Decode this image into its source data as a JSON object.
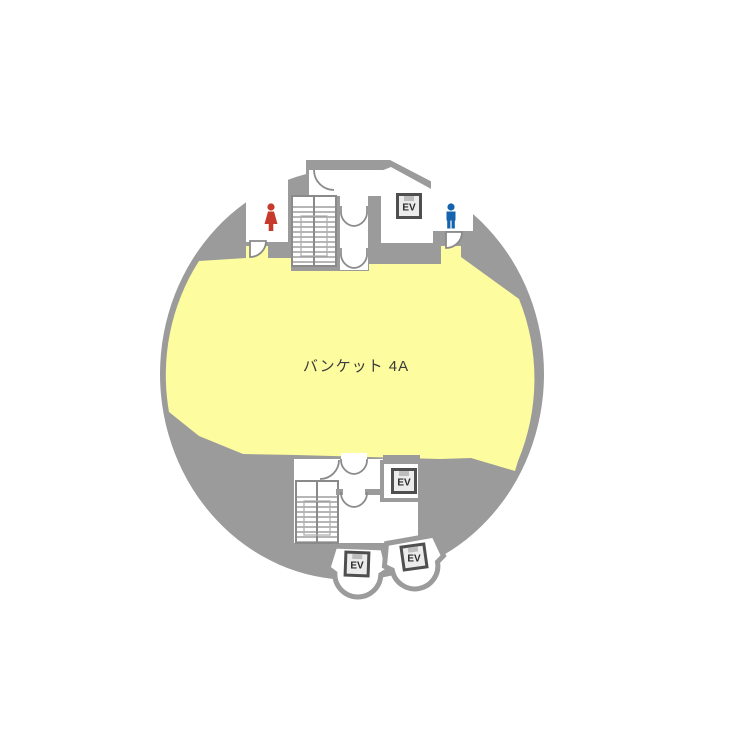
{
  "page": {
    "background": "#ffffff"
  },
  "floorplan": {
    "shape": "circular-floor",
    "labels": {
      "banquet": "バンケット 4A",
      "ev": "EV"
    },
    "areas": [
      {
        "name": "banquet-hall",
        "label": "バンケット 4A",
        "color": "#fdfc9e"
      },
      {
        "name": "womens-restroom",
        "icon": "female-icon",
        "icon_color": "#c63a2b"
      },
      {
        "name": "mens-restroom",
        "icon": "male-icon",
        "icon_color": "#1663ad"
      },
      {
        "name": "stairs-north"
      },
      {
        "name": "stairs-south"
      },
      {
        "name": "elevator-north",
        "label": "EV"
      },
      {
        "name": "elevator-south",
        "label": "EV"
      },
      {
        "name": "elevator-bay-left",
        "label": "EV"
      },
      {
        "name": "elevator-bay-right",
        "label": "EV"
      }
    ],
    "colors": {
      "floor_gray": "#9b9b9b",
      "room_white": "#ffffff",
      "banquet_yellow": "#fdfc9e",
      "wall_stroke": "#8a8a8a",
      "ev_frame": "#4f4f4f",
      "ev_fill": "#ececec",
      "ev_text": "#2b2b2b",
      "female_icon": "#c63a2b",
      "male_icon": "#1663ad",
      "label_text": "#3b3b3b"
    }
  }
}
